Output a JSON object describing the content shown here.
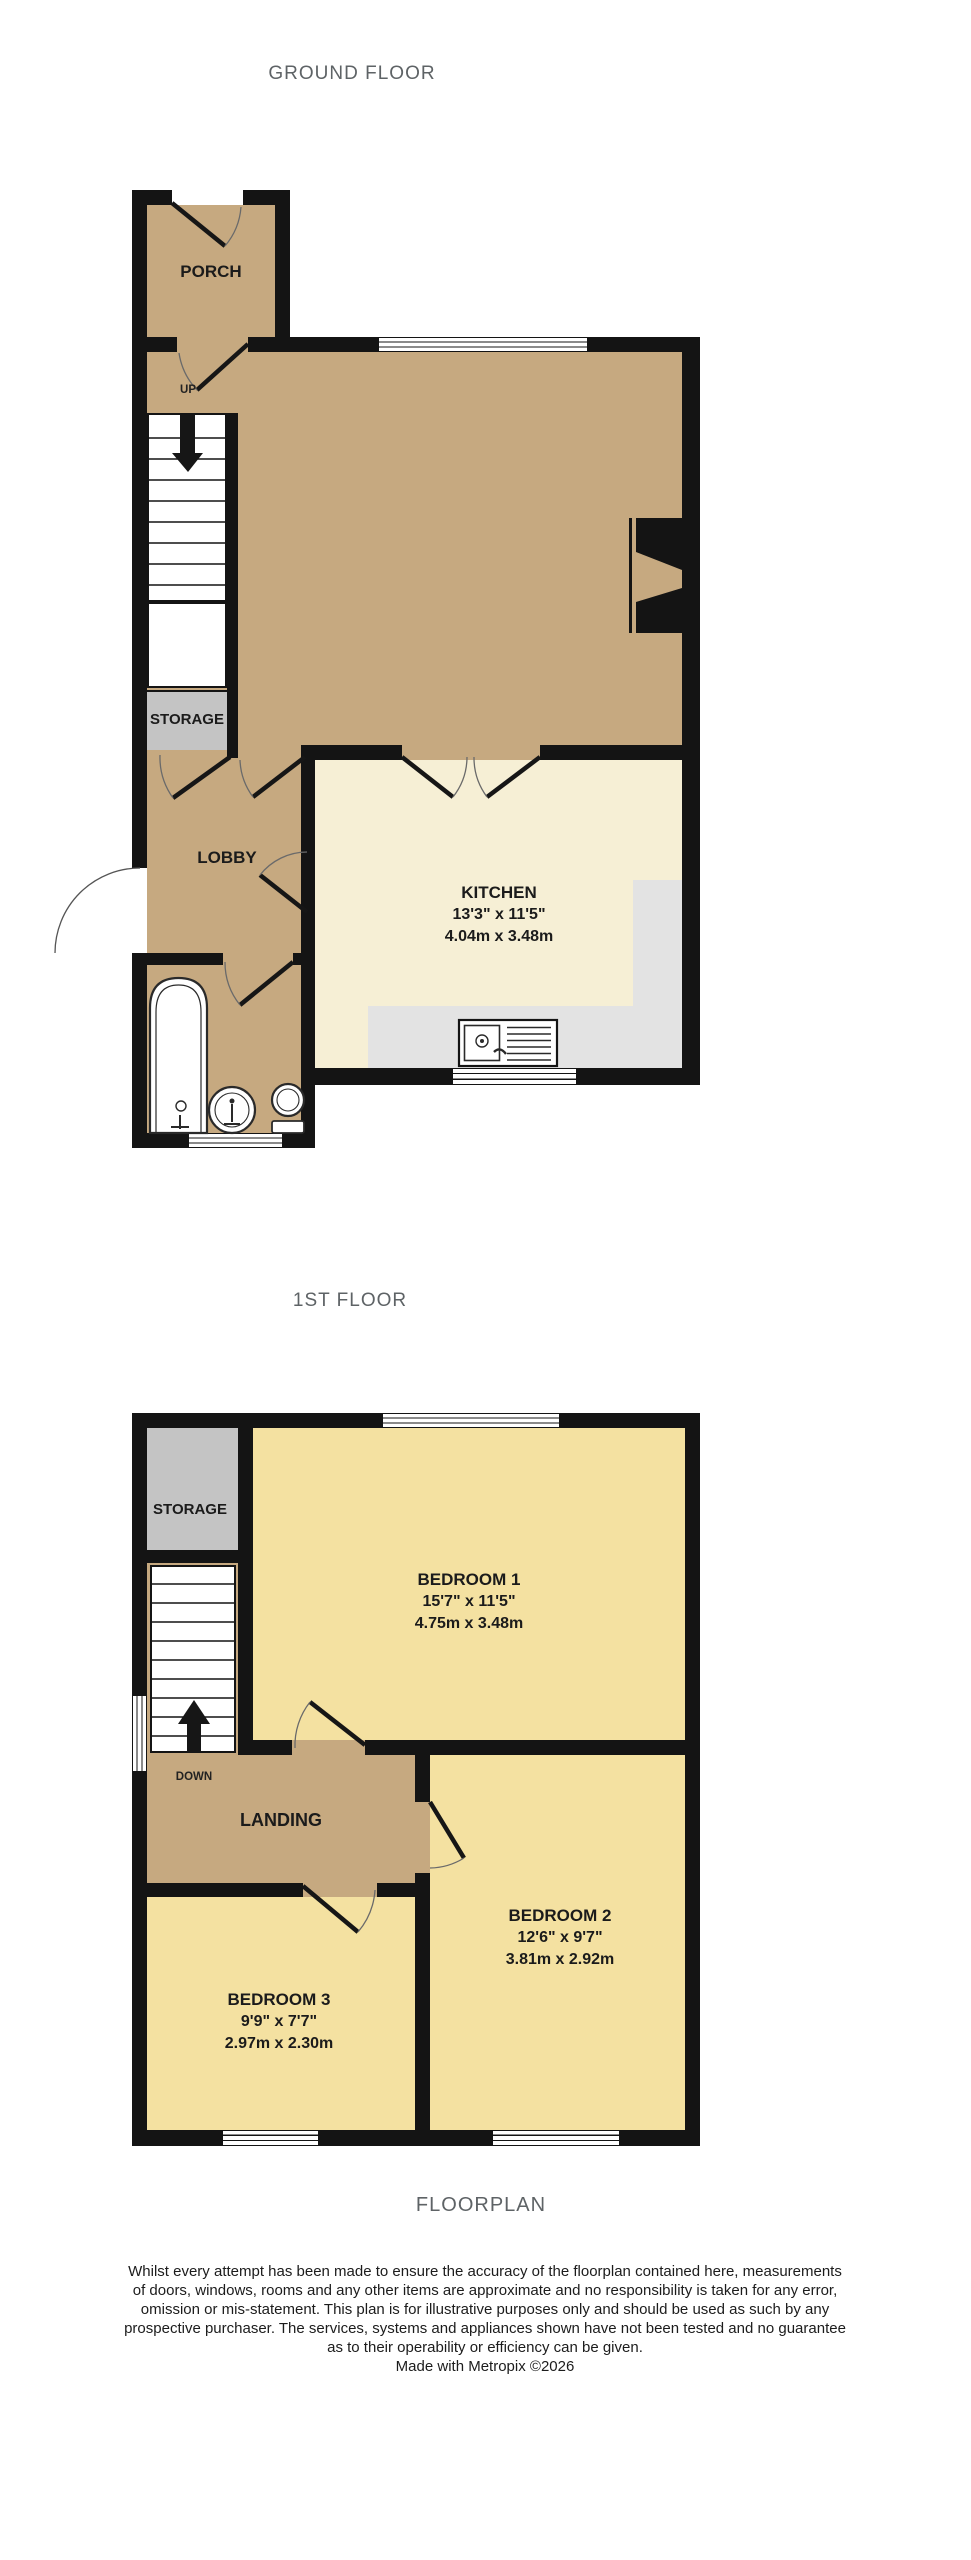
{
  "titles": {
    "ground": "GROUND FLOOR",
    "first": "1ST FLOOR",
    "footer": "FLOORPLAN"
  },
  "ground_floor": {
    "porch": {
      "label": "PORCH"
    },
    "stairs": {
      "label": "UP"
    },
    "storage": {
      "label": "STORAGE"
    },
    "lobby": {
      "label": "LOBBY"
    },
    "kitchen": {
      "label": "KITCHEN",
      "dims_imperial": "13'3\"  x 11'5\"",
      "dims_metric": "4.04m  x 3.48m"
    }
  },
  "first_floor": {
    "storage": {
      "label": "STORAGE"
    },
    "stairs": {
      "label": "DOWN"
    },
    "landing": {
      "label": "LANDING"
    },
    "bedroom1": {
      "label": "BEDROOM 1",
      "dims_imperial": "15'7\"  x 11'5\"",
      "dims_metric": "4.75m  x 3.48m"
    },
    "bedroom2": {
      "label": "BEDROOM 2",
      "dims_imperial": "12'6\"  x 9'7\"",
      "dims_metric": "3.81m  x 2.92m"
    },
    "bedroom3": {
      "label": "BEDROOM 3",
      "dims_imperial": "9'9\"  x 7'7\"",
      "dims_metric": "2.97m  x 2.30m"
    }
  },
  "disclaimer": {
    "lines": [
      "Whilst every attempt has been made to ensure the accuracy of the floorplan contained here, measurements",
      "of doors, windows, rooms and any other items are approximate and no responsibility is taken for any error,",
      "omission or mis-statement. This plan is for illustrative purposes only and should be used as such by any",
      "prospective purchaser. The services, systems and appliances shown have not been tested and no guarantee",
      "as to their operability or efficiency can be given."
    ],
    "credit": "Made with Metropix ©2026"
  },
  "colors": {
    "wall": "#141414",
    "floor_tan": "#c6a980",
    "kitchen_cream": "#f6efd5",
    "bedroom_yellow": "#f4e1a1",
    "storage_gray": "#c4c4c4",
    "counter_gray": "#e3e3e3",
    "title_gray": "#5e6366"
  }
}
